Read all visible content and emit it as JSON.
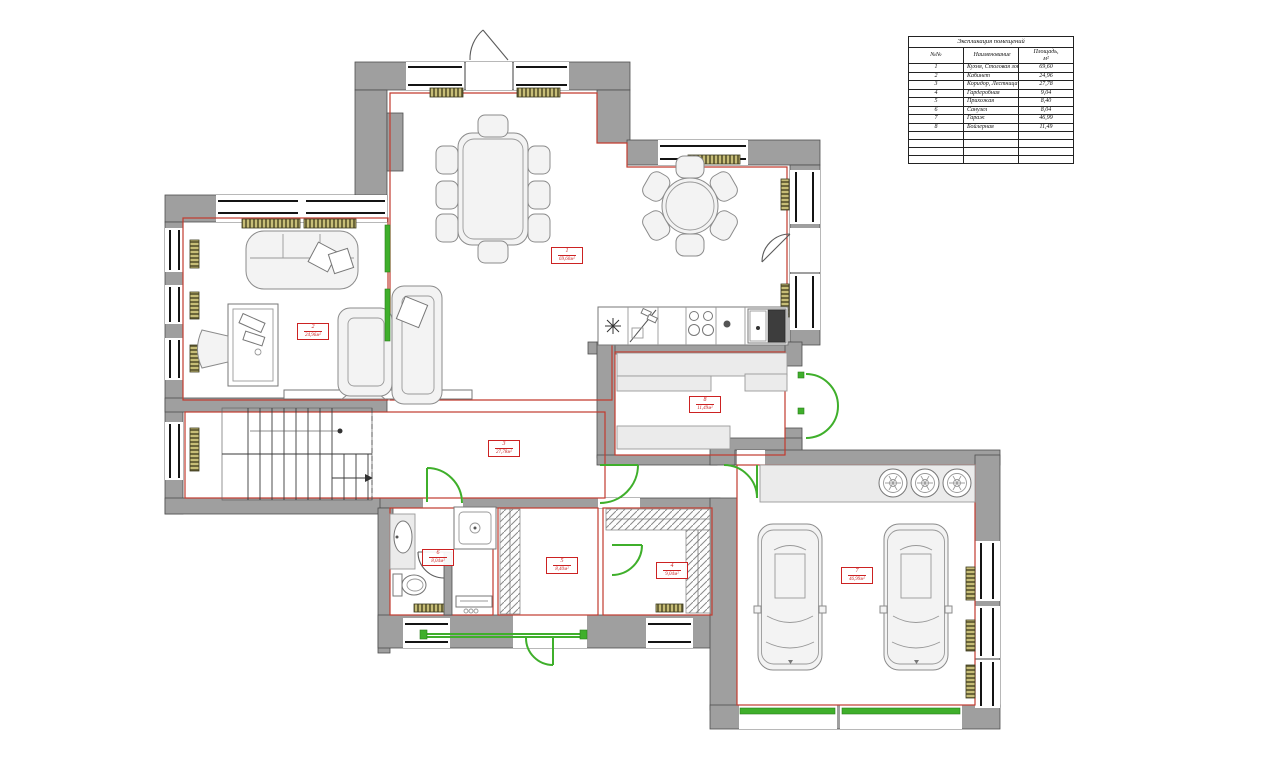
{
  "colors": {
    "wall": "#9f9f9f",
    "red": "#c23b2e",
    "green": "#3faf2b",
    "radiator": "#c6bd77",
    "label_red": "#cc2222"
  },
  "explication": {
    "title": "Экспликация помещений",
    "headers": {
      "num": "№№",
      "name": "Наименование",
      "area_line1": "Площадь,",
      "area_line2": "м²"
    },
    "rows": [
      {
        "num": "1",
        "name": "Кухня, Столовая зона, Гостиная",
        "area": "69,60"
      },
      {
        "num": "2",
        "name": "Кабинет",
        "area": "24,96"
      },
      {
        "num": "3",
        "name": "Коридор, Лестница",
        "area": "27,78"
      },
      {
        "num": "4",
        "name": "Гардеробная",
        "area": "9,04"
      },
      {
        "num": "5",
        "name": "Прихожая",
        "area": "8,40"
      },
      {
        "num": "6",
        "name": "Санузел",
        "area": "8,04"
      },
      {
        "num": "7",
        "name": "Гараж",
        "area": "46,99"
      },
      {
        "num": "8",
        "name": "Бойлерная",
        "area": "11,49"
      }
    ]
  },
  "room_labels": [
    {
      "num": "1",
      "area": "69,60м²"
    },
    {
      "num": "2",
      "area": "24,96м²"
    },
    {
      "num": "3",
      "area": "27,78м²"
    },
    {
      "num": "4",
      "area": "9,04м²"
    },
    {
      "num": "5",
      "area": "8,40м²"
    },
    {
      "num": "6",
      "area": "8,04м²"
    },
    {
      "num": "7",
      "area": "46,99м²"
    },
    {
      "num": "8",
      "area": "11,49м²"
    }
  ]
}
